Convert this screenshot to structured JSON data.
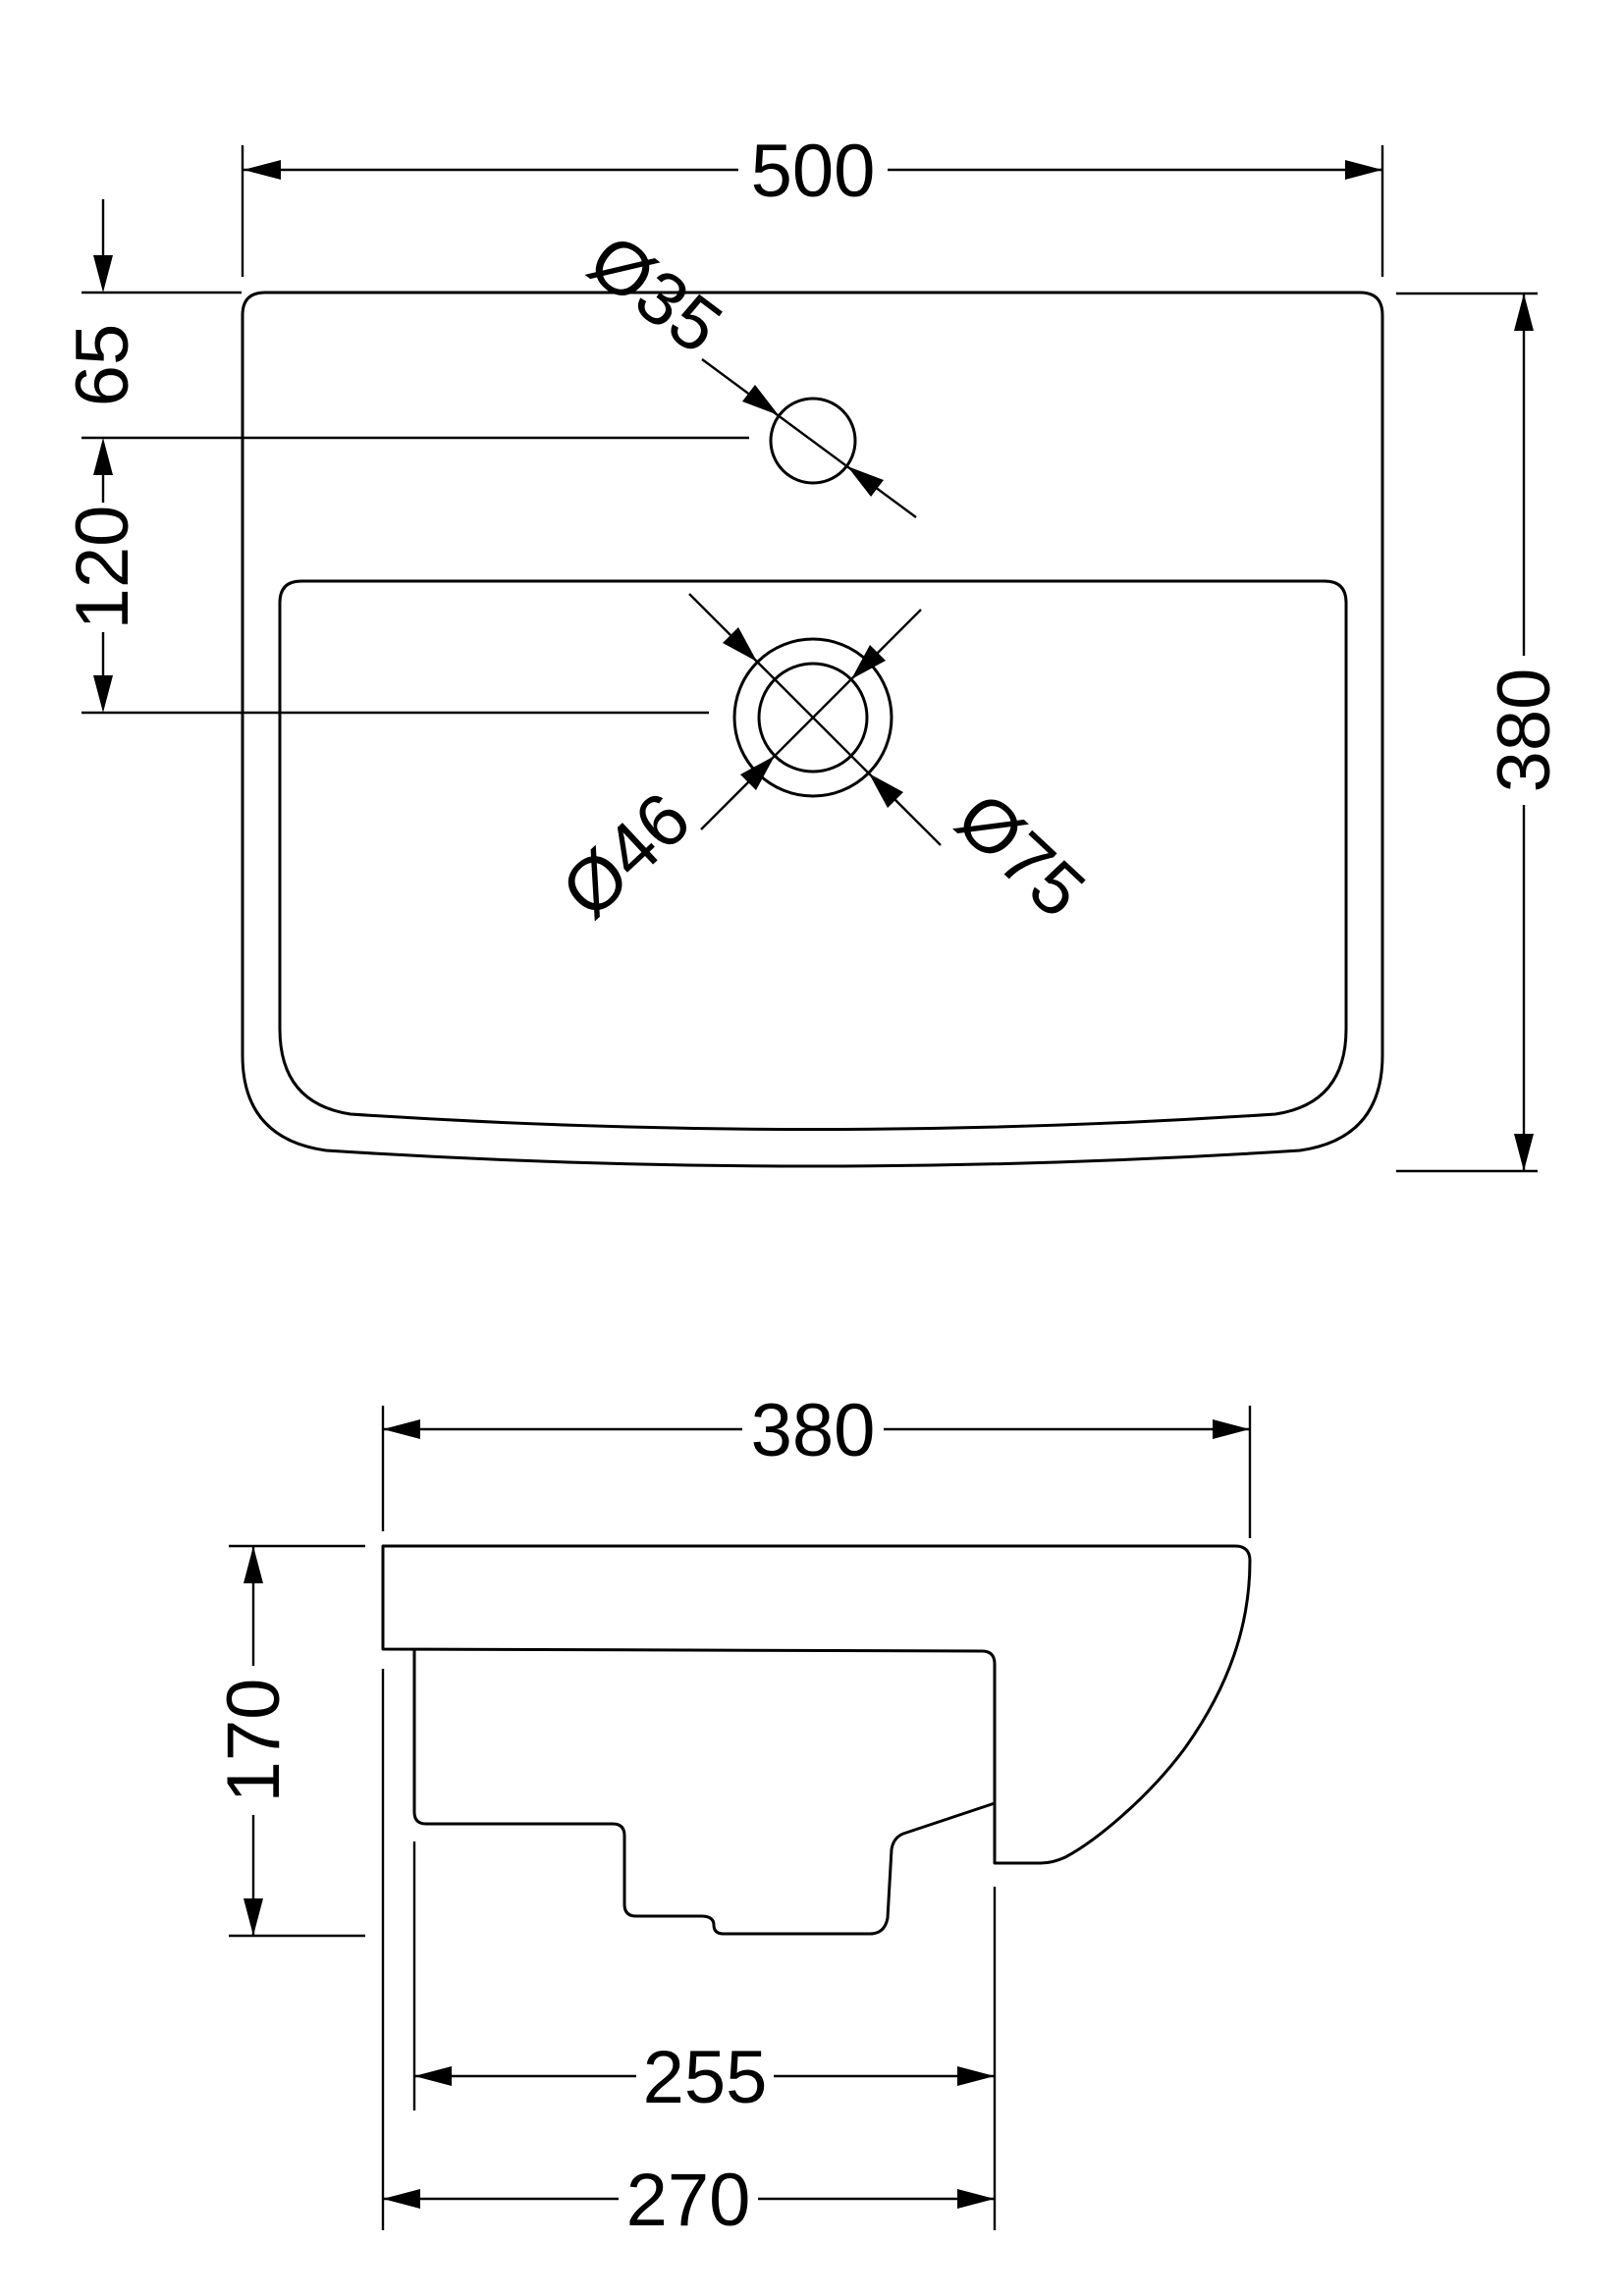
{
  "drawing": {
    "title": "basin-technical-drawing",
    "background_color": "#ffffff",
    "line_color": "#000000",
    "plan_view": {
      "width_label": "500",
      "tap_offset_label": "65",
      "tap_to_waste_label": "120",
      "tap_hole_label": "Ø35",
      "waste_inner_label": "Ø46",
      "waste_outer_label": "Ø75",
      "depth_label": "380"
    },
    "side_view": {
      "width_label": "380",
      "height_label": "170",
      "sump_width_label": "255",
      "base_width_label": "270"
    }
  }
}
